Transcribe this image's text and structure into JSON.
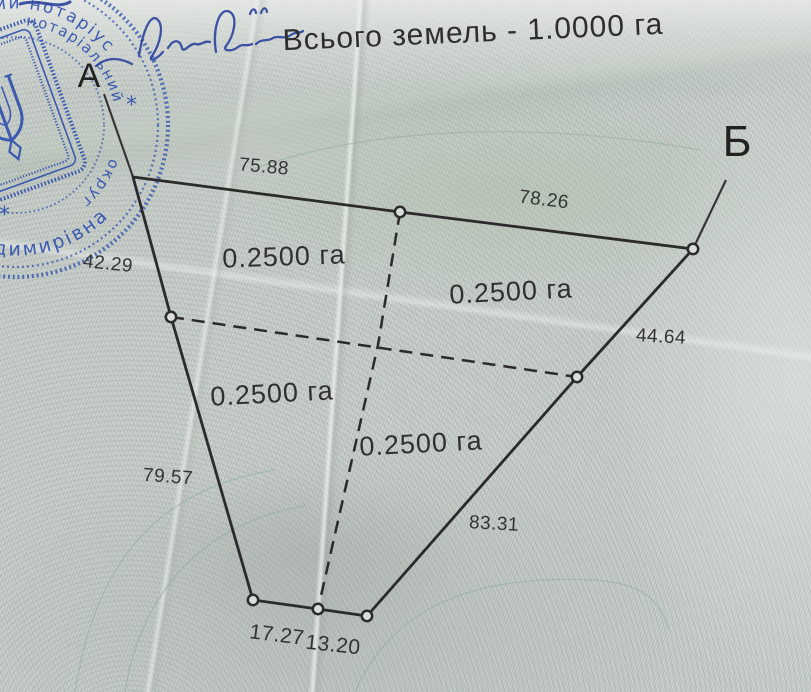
{
  "document": {
    "title": "Всього земель - 1.0000 га"
  },
  "plot": {
    "corner_labels": {
      "a": "А",
      "b": "Б"
    },
    "area_labels": [
      "0.2500 га",
      "0.2500 га",
      "0.2500 га",
      "0.2500 га"
    ],
    "side_lengths": {
      "segment_a_mid": "75.88",
      "segment_mid_b": "78.26",
      "left_upper": "42.29",
      "right_upper": "44.64",
      "left_lower": "79.57",
      "right_lower": "83.31",
      "bottom_left": "17.27",
      "bottom_right": "13.20"
    }
  },
  "stamp": {
    "arc_text_top": "ий нотаріус",
    "arc_text_right": "нотаріальний",
    "arc_text_lower_right": "округ",
    "arc_text_bottom": "а Володимирівна",
    "star": "*",
    "color": "#2d4fae"
  },
  "colors": {
    "ink": "#2b2b2b",
    "paper": "#ccd1cd",
    "stamp_blue": "#2d4fae",
    "guilloche_green": "#8fae9b"
  }
}
